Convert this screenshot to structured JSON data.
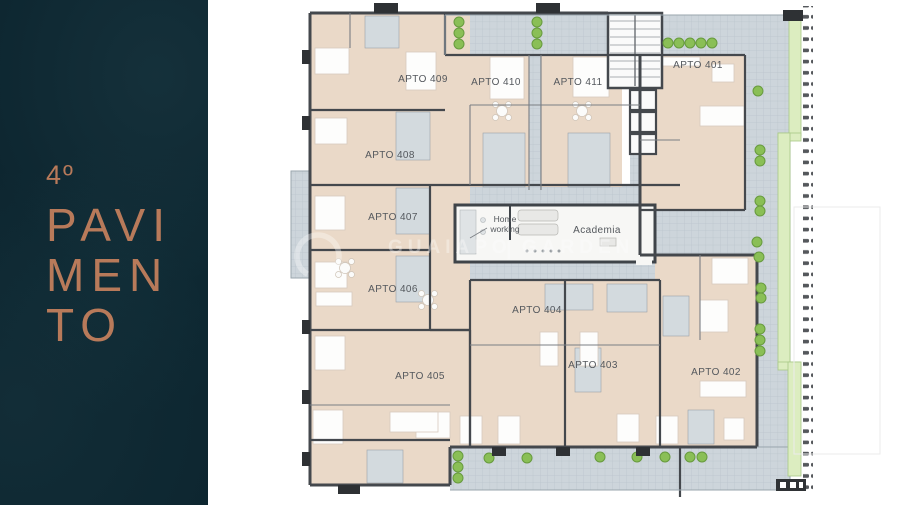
{
  "panel": {
    "floor_number": "4º",
    "title_line1": "PAVI",
    "title_line2": "MEN",
    "title_line3": "TO"
  },
  "apartments": [
    {
      "label": "APTO 401"
    },
    {
      "label": "APTO 402"
    },
    {
      "label": "APTO 403"
    },
    {
      "label": "APTO 404"
    },
    {
      "label": "APTO 405"
    },
    {
      "label": "APTO 406"
    },
    {
      "label": "APTO 407"
    },
    {
      "label": "APTO 408"
    },
    {
      "label": "APTO 409"
    },
    {
      "label": "APTO 410"
    },
    {
      "label": "APTO 411"
    }
  ],
  "amenities": {
    "home_working_line1": "Home",
    "home_working_line2": "working",
    "academia": "Academia"
  },
  "watermark": {
    "name": "GUAIAPO",
    "separator": "|",
    "suffix": "GARDEN"
  },
  "colors": {
    "panel_bg": "#0d2630",
    "accent_copper": "#b87a5a",
    "apartment_fill": "#ead9c8",
    "terrace_fill": "#cdd5db",
    "wall": "#44484d",
    "plant_green": "#8abf56",
    "planter_green": "#dcedc0",
    "label_text": "#54585d"
  }
}
